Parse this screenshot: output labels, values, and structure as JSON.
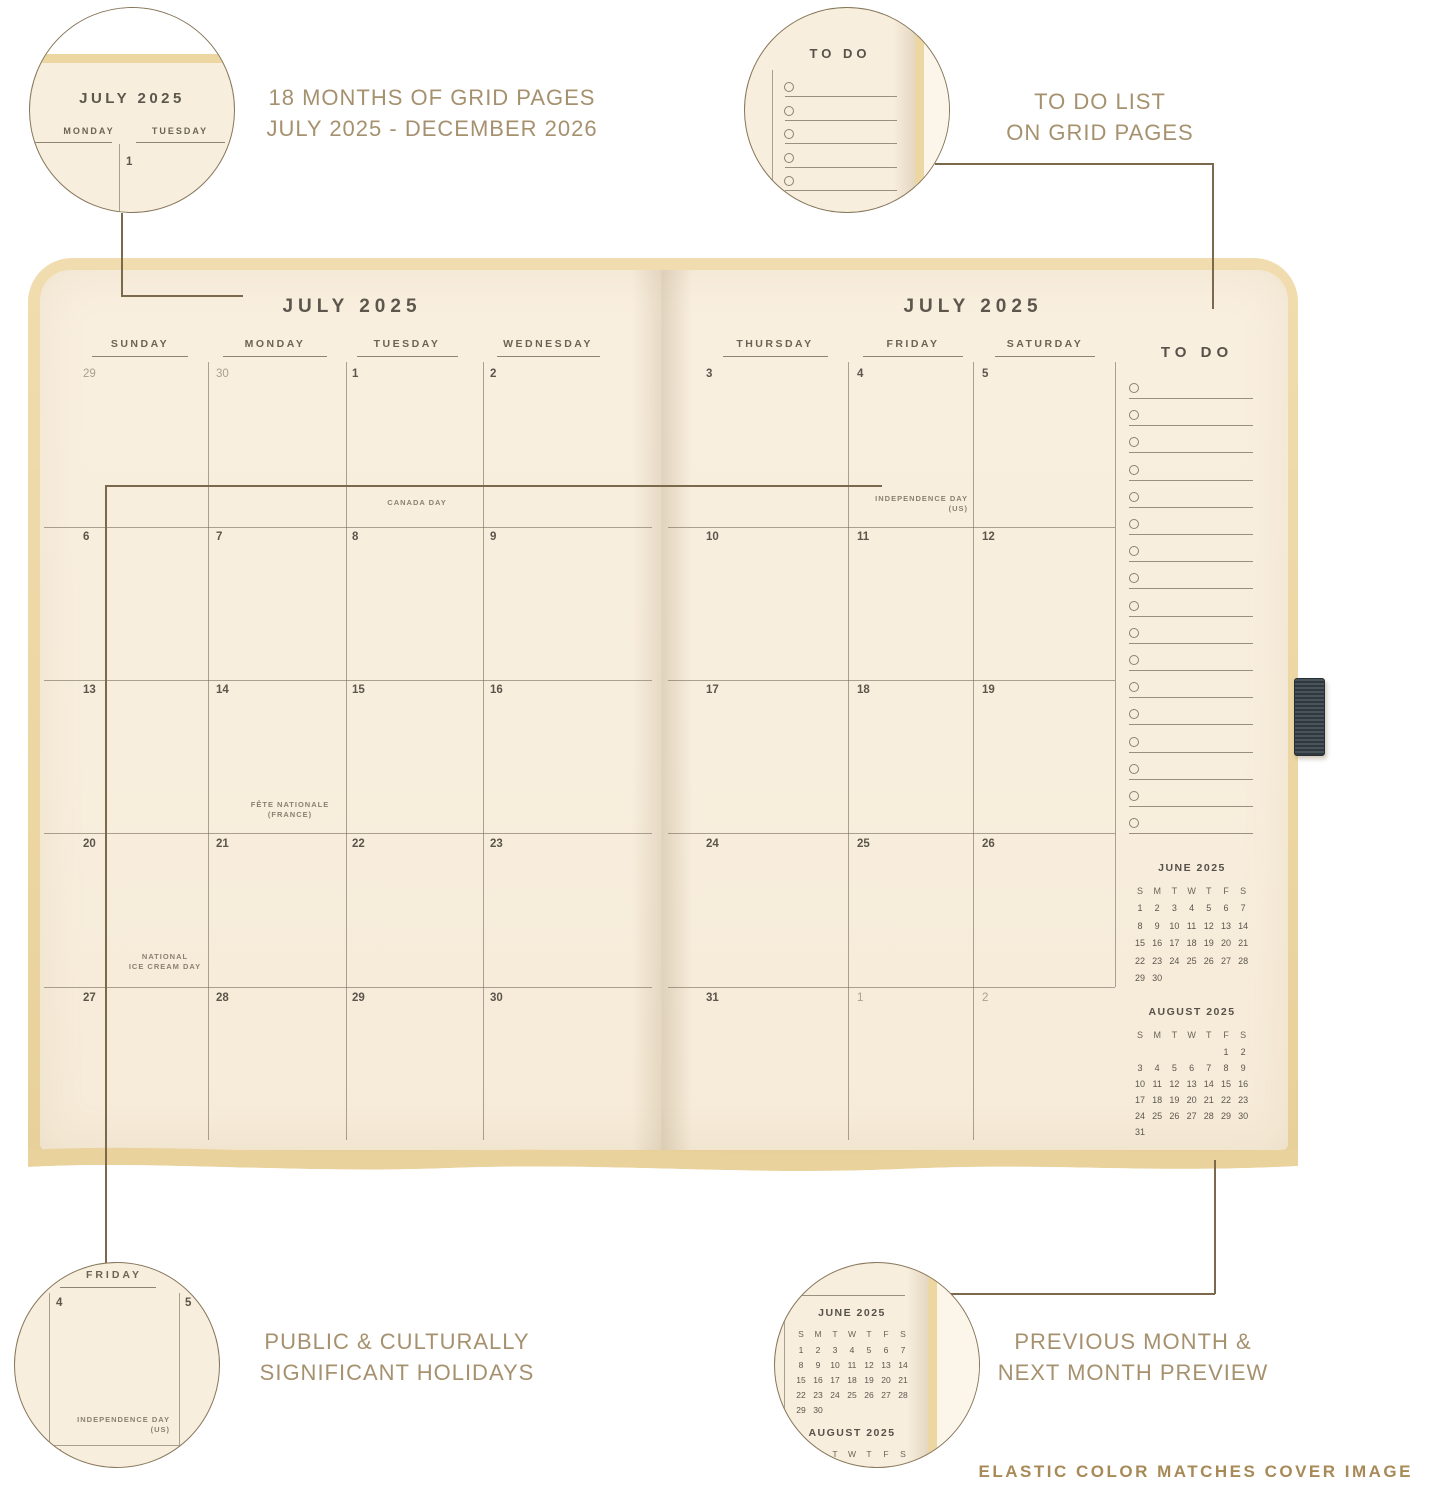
{
  "annotations": {
    "top_left": {
      "line1": "18 MONTHS OF GRID PAGES",
      "line2": "JULY 2025 - DECEMBER 2026"
    },
    "top_right": {
      "line1": "TO DO LIST",
      "line2": "ON GRID PAGES"
    },
    "bottom_left": {
      "line1": "PUBLIC & CULTURALLY",
      "line2": "SIGNIFICANT HOLIDAYS"
    },
    "bottom_right": {
      "line1": "PREVIOUS MONTH &",
      "line2": "NEXT MONTH PREVIEW"
    },
    "footer": "ELASTIC COLOR MATCHES COVER IMAGE"
  },
  "planner": {
    "left_page": {
      "title": "JULY 2025",
      "day_headers": [
        "SUNDAY",
        "MONDAY",
        "TUESDAY",
        "WEDNESDAY"
      ],
      "weeks": [
        [
          "29",
          "30",
          "1",
          "2"
        ],
        [
          "6",
          "7",
          "8",
          "9"
        ],
        [
          "13",
          "14",
          "15",
          "16"
        ],
        [
          "20",
          "21",
          "22",
          "23"
        ],
        [
          "27",
          "28",
          "29",
          "30"
        ]
      ],
      "muted_cells": [
        [
          0,
          0
        ],
        [
          0,
          1
        ]
      ],
      "holidays": [
        {
          "lines": [
            "CANADA DAY"
          ]
        },
        {
          "lines": [
            "FÊTE NATIONALE",
            "(FRANCE)"
          ]
        },
        {
          "lines": [
            "NATIONAL",
            "ICE CREAM DAY"
          ]
        }
      ]
    },
    "right_page": {
      "title": "JULY 2025",
      "day_headers": [
        "THURSDAY",
        "FRIDAY",
        "SATURDAY"
      ],
      "weeks": [
        [
          "3",
          "4",
          "5"
        ],
        [
          "10",
          "11",
          "12"
        ],
        [
          "17",
          "18",
          "19"
        ],
        [
          "24",
          "25",
          "26"
        ],
        [
          "31",
          "1",
          "2"
        ]
      ],
      "muted_cells": [
        [
          4,
          1
        ],
        [
          4,
          2
        ]
      ],
      "holidays": [
        {
          "lines": [
            "INDEPENDENCE DAY",
            "(US)"
          ]
        }
      ]
    },
    "todo": {
      "title": "TO DO",
      "line_count": 17
    },
    "mini_calendars": [
      {
        "title": "JUNE 2025",
        "day_letters": [
          "S",
          "M",
          "T",
          "W",
          "T",
          "F",
          "S"
        ],
        "rows": [
          [
            "1",
            "2",
            "3",
            "4",
            "5",
            "6",
            "7"
          ],
          [
            "8",
            "9",
            "10",
            "11",
            "12",
            "13",
            "14"
          ],
          [
            "15",
            "16",
            "17",
            "18",
            "19",
            "20",
            "21"
          ],
          [
            "22",
            "23",
            "24",
            "25",
            "26",
            "27",
            "28"
          ],
          [
            "29",
            "30",
            "",
            "",
            "",
            "",
            ""
          ]
        ]
      },
      {
        "title": "AUGUST 2025",
        "day_letters": [
          "S",
          "M",
          "T",
          "W",
          "T",
          "F",
          "S"
        ],
        "rows": [
          [
            "",
            "",
            "",
            "",
            "",
            "1",
            "2"
          ],
          [
            "3",
            "4",
            "5",
            "6",
            "7",
            "8",
            "9"
          ],
          [
            "10",
            "11",
            "12",
            "13",
            "14",
            "15",
            "16"
          ],
          [
            "17",
            "18",
            "19",
            "20",
            "21",
            "22",
            "23"
          ],
          [
            "24",
            "25",
            "26",
            "27",
            "28",
            "29",
            "30"
          ],
          [
            "31",
            "",
            "",
            "",
            "",
            "",
            ""
          ]
        ]
      }
    ]
  },
  "callouts": {
    "top_left_detail": {
      "title": "JULY 2025",
      "headers": [
        "MONDAY",
        "TUESDAY"
      ],
      "date": "1"
    },
    "top_right_detail": {
      "title": "TO DO",
      "item_count": 5
    },
    "bottom_left_detail": {
      "day": "FRIDAY",
      "date_top_left": "4",
      "date_top_right": "5",
      "date_bottom": "11",
      "holiday_lines": [
        "INDEPENDENCE DAY",
        "(US)"
      ]
    },
    "bottom_right_detail": {
      "uses_mini_calendars": "JUNE 2025 / AUGUST 2025"
    }
  },
  "colors": {
    "cover_tan": "#ecd6a2",
    "page_cream": "#f8eedd",
    "ink": "#5b554b",
    "muted_ink": "#a99f8e",
    "grid_line": "#766c5c",
    "annotation_text": "#a6916f",
    "footer_text": "#a78a57",
    "callout_stroke": "#86765a",
    "elastic_loop": "#3e474d"
  }
}
